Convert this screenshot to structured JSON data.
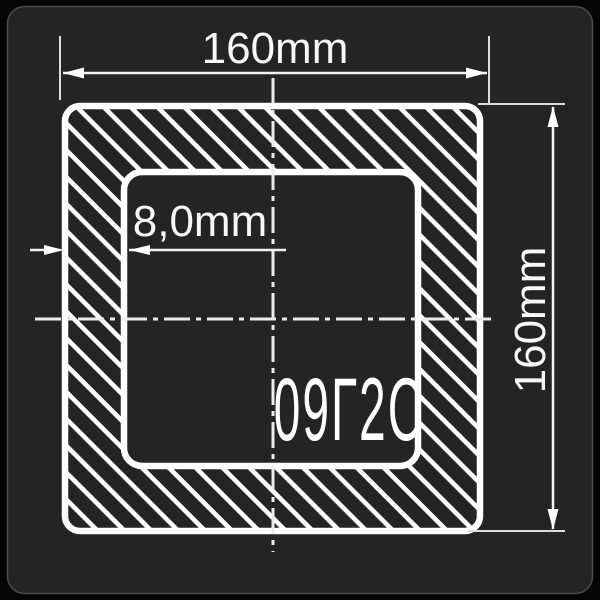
{
  "drawing": {
    "dimensions": {
      "outer_width_label": "160mm",
      "outer_height_label": "160mm",
      "wall_thickness_label": "8,0mm"
    },
    "steel_grade_label": "09Г2С",
    "colors": {
      "page_background": "#050505",
      "panel_background": "#242424",
      "panel_border": "#4a4a4a",
      "contour_line": "#ffffff",
      "dimension_line": "#e2e2e2"
    }
  }
}
